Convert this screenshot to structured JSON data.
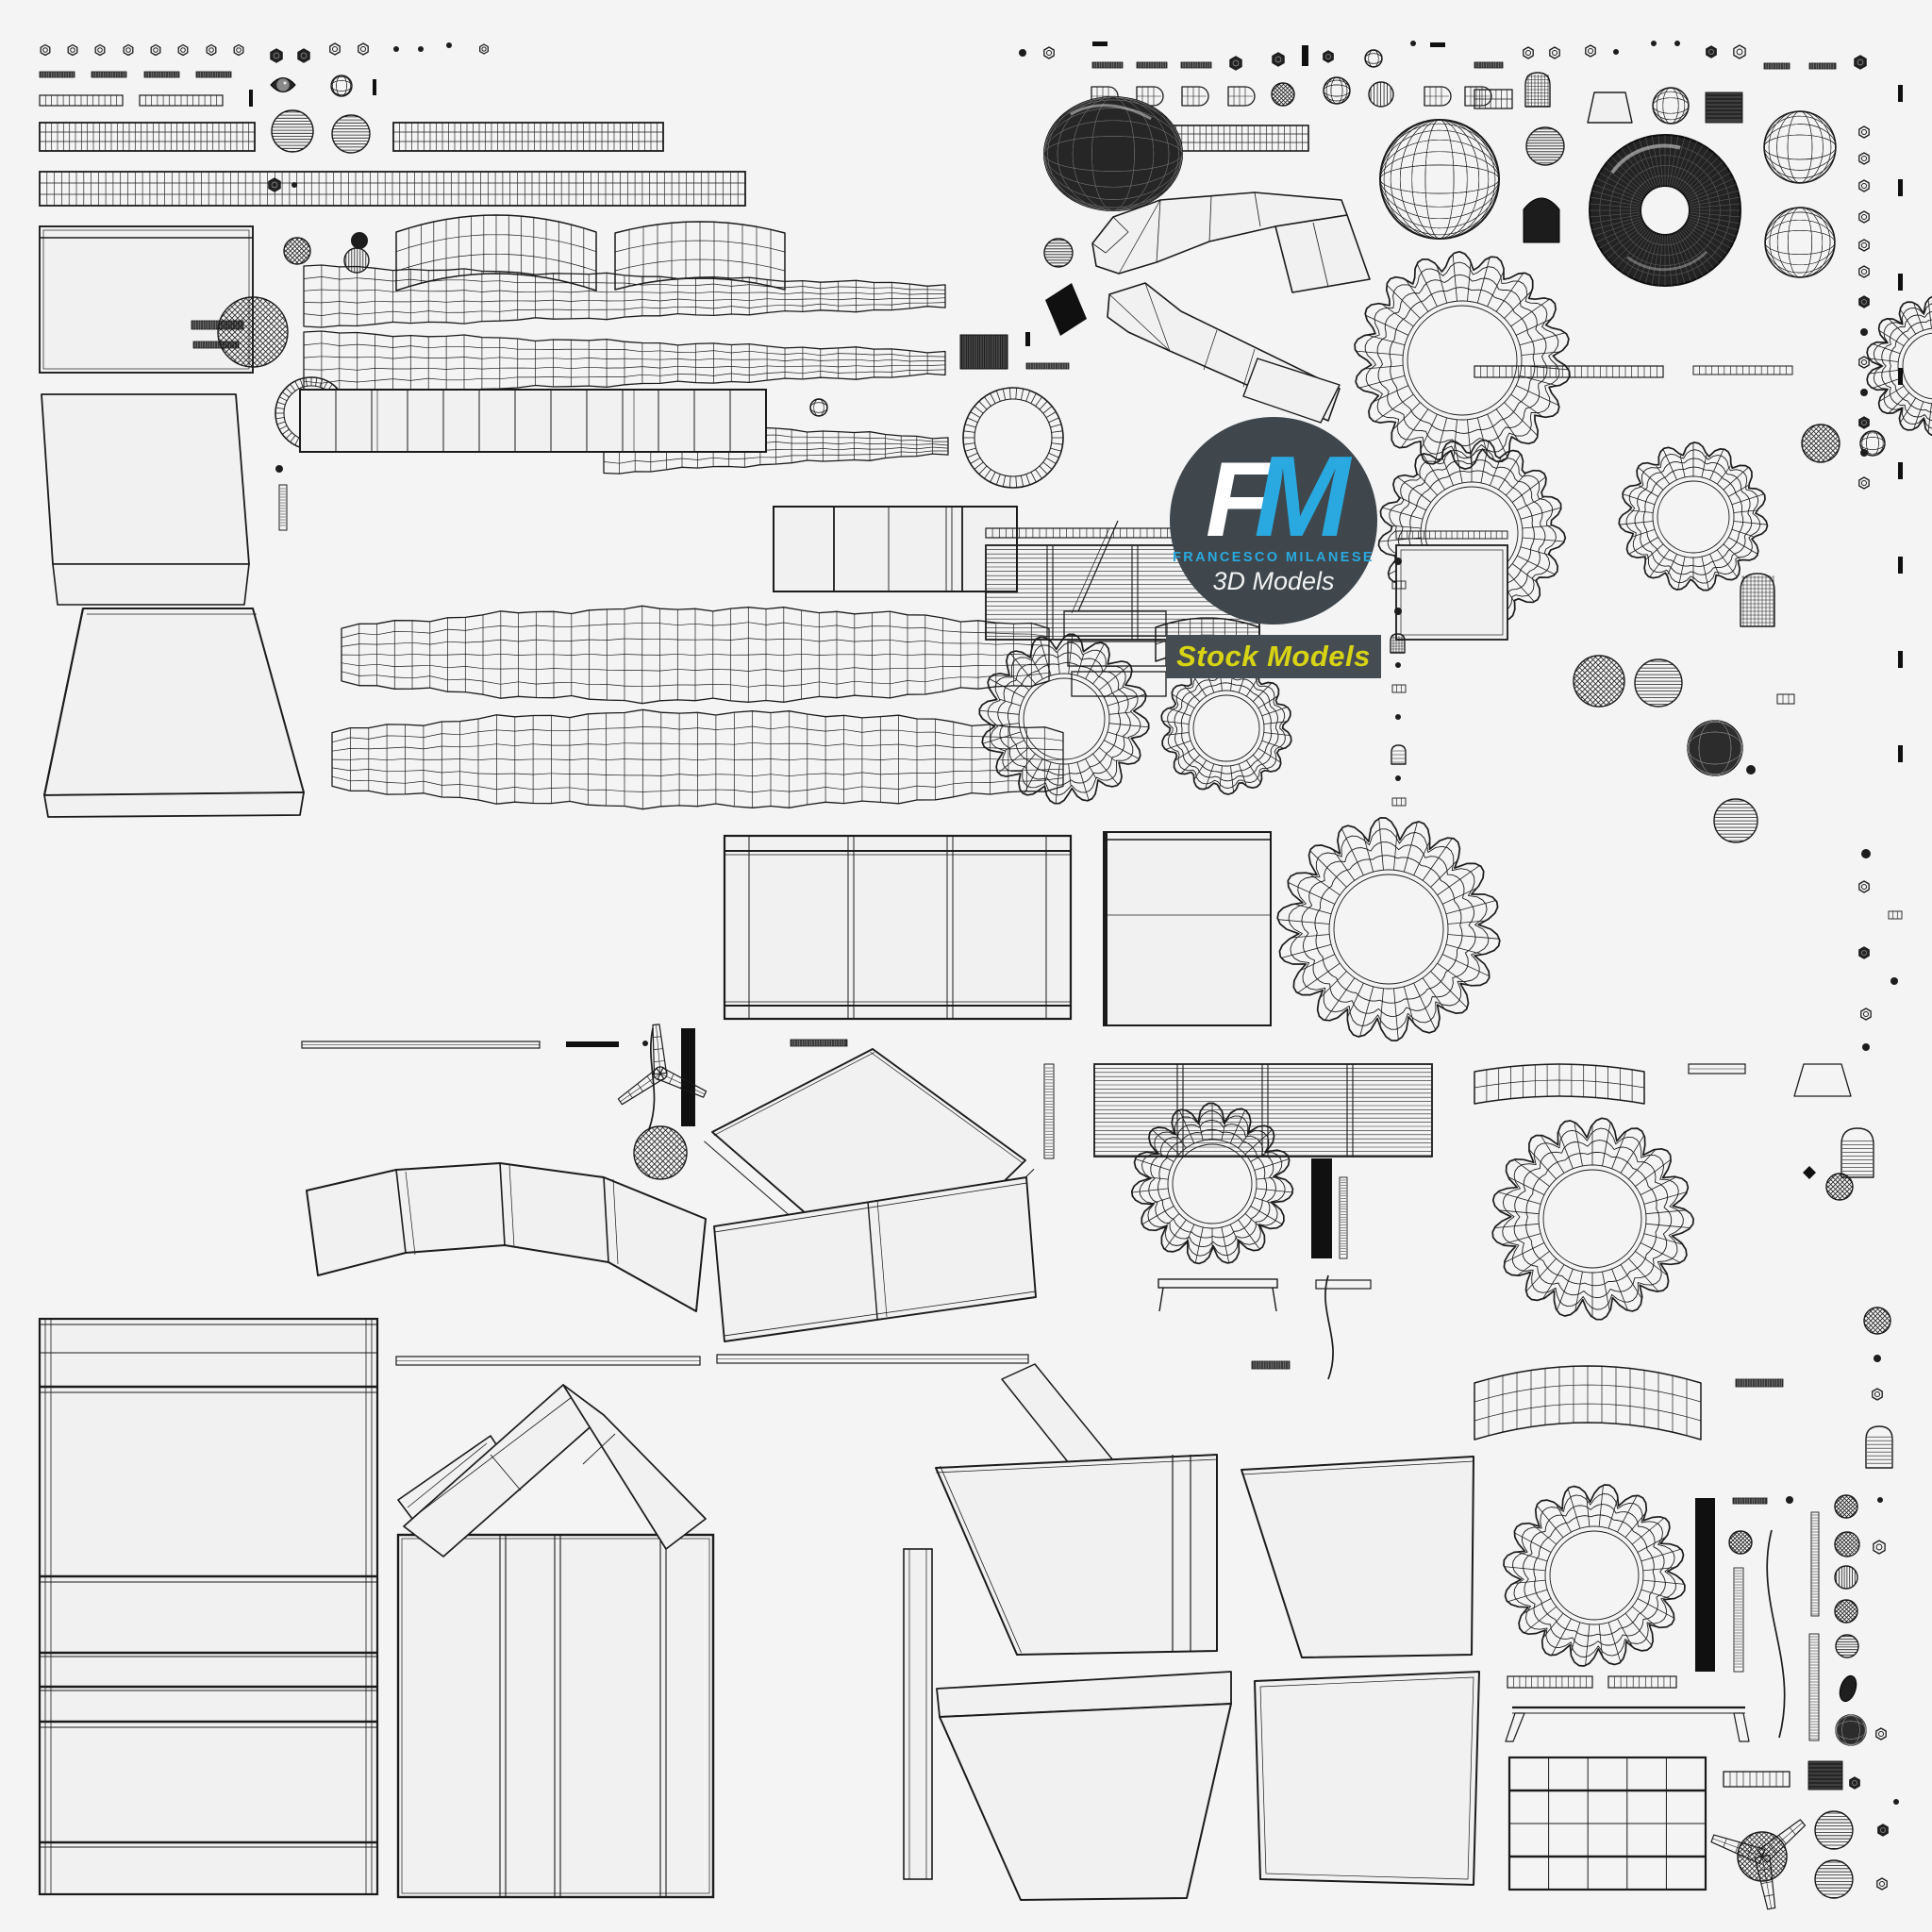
{
  "watermark": {
    "initial_f": "F",
    "initial_m": "M",
    "name": "FRANCESCO MILANESE",
    "subtitle": "3D Models",
    "badge": "Stock Models"
  },
  "colors": {
    "background": "#f4f4f5",
    "wireframe": "#1b1b1b",
    "panel_fill": "#f1f1f2",
    "logo_circle": "#3f474c",
    "accent_blue": "#29a9e0",
    "badge_bg": "#454d52",
    "badge_text": "#d8d414",
    "letter_f": "#ffffff",
    "subtitle_color": "#f2f2f2"
  }
}
